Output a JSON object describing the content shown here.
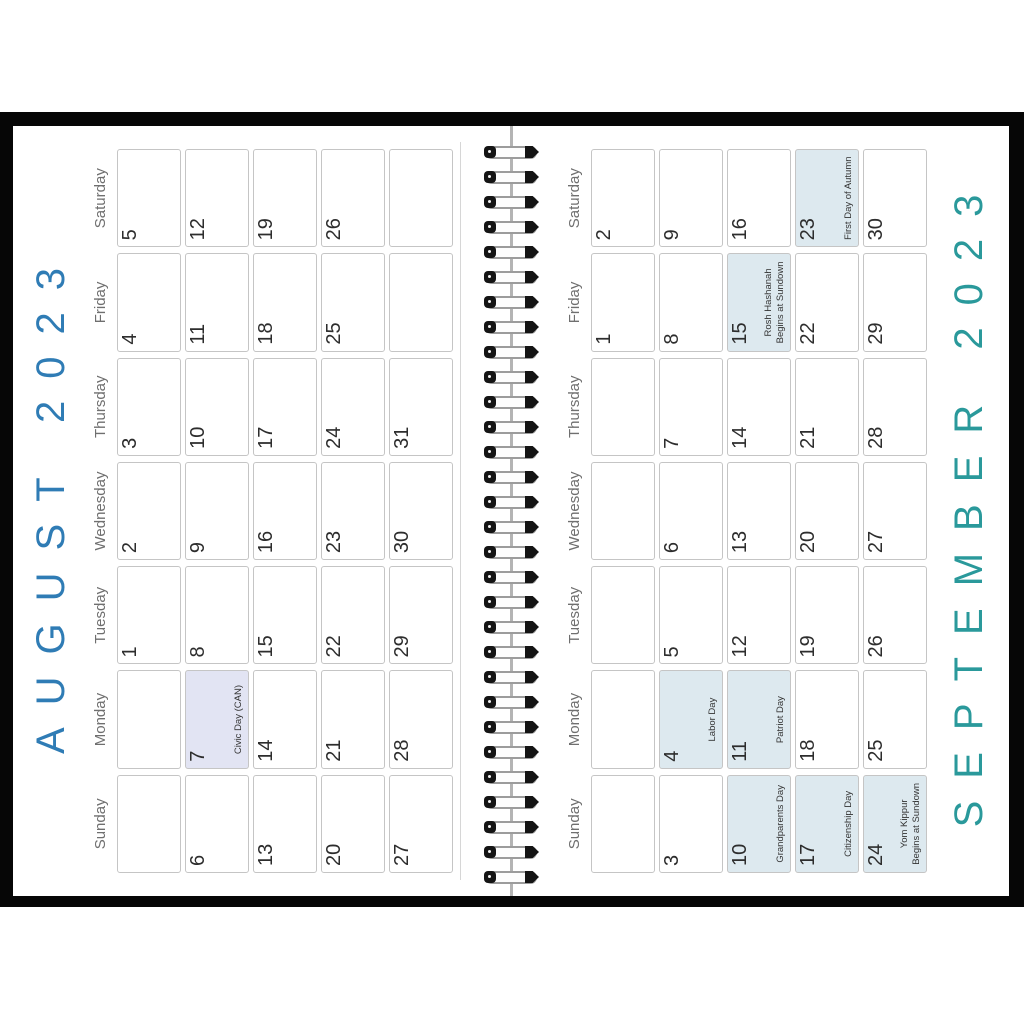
{
  "calendar": {
    "year": "2023",
    "binding": {
      "ring_count": 30
    },
    "pages": [
      {
        "id": "august",
        "title": "AUGUST 2023",
        "title_color": "#2f7cb5",
        "title_position": "top",
        "highlight_color": "#e2e4f3",
        "day_headers": [
          "Sunday",
          "Monday",
          "Tuesday",
          "Wednesday",
          "Thursday",
          "Friday",
          "Saturday"
        ],
        "weeks": [
          [
            {
              "day": ""
            },
            {
              "day": ""
            },
            {
              "day": "1"
            },
            {
              "day": "2"
            },
            {
              "day": "3"
            },
            {
              "day": "4"
            },
            {
              "day": "5"
            }
          ],
          [
            {
              "day": "6"
            },
            {
              "day": "7",
              "holiday": "Civic Day (CAN)",
              "highlight": true
            },
            {
              "day": "8"
            },
            {
              "day": "9"
            },
            {
              "day": "10"
            },
            {
              "day": "11"
            },
            {
              "day": "12"
            }
          ],
          [
            {
              "day": "13"
            },
            {
              "day": "14"
            },
            {
              "day": "15"
            },
            {
              "day": "16"
            },
            {
              "day": "17"
            },
            {
              "day": "18"
            },
            {
              "day": "19"
            }
          ],
          [
            {
              "day": "20"
            },
            {
              "day": "21"
            },
            {
              "day": "22"
            },
            {
              "day": "23"
            },
            {
              "day": "24"
            },
            {
              "day": "25"
            },
            {
              "day": "26"
            }
          ],
          [
            {
              "day": "27"
            },
            {
              "day": "28"
            },
            {
              "day": "29"
            },
            {
              "day": "30"
            },
            {
              "day": "31"
            },
            {
              "day": ""
            },
            {
              "day": ""
            }
          ]
        ]
      },
      {
        "id": "september",
        "title": "SEPTEMBER 2023",
        "title_color": "#2a999b",
        "title_position": "bottom",
        "highlight_color": "#dde9ef",
        "day_headers": [
          "Sunday",
          "Monday",
          "Tuesday",
          "Wednesday",
          "Thursday",
          "Friday",
          "Saturday"
        ],
        "weeks": [
          [
            {
              "day": ""
            },
            {
              "day": ""
            },
            {
              "day": ""
            },
            {
              "day": ""
            },
            {
              "day": ""
            },
            {
              "day": "1"
            },
            {
              "day": "2"
            }
          ],
          [
            {
              "day": "3"
            },
            {
              "day": "4",
              "holiday": "Labor Day",
              "highlight": true
            },
            {
              "day": "5"
            },
            {
              "day": "6"
            },
            {
              "day": "7"
            },
            {
              "day": "8"
            },
            {
              "day": "9"
            }
          ],
          [
            {
              "day": "10",
              "holiday": "Grandparents Day",
              "highlight": true
            },
            {
              "day": "11",
              "holiday": "Patriot Day",
              "highlight": true
            },
            {
              "day": "12"
            },
            {
              "day": "13"
            },
            {
              "day": "14"
            },
            {
              "day": "15",
              "holiday": "Rosh Hashanah\nBegins at Sundown",
              "highlight": true
            },
            {
              "day": "16"
            }
          ],
          [
            {
              "day": "17",
              "holiday": "Citizenship Day",
              "highlight": true
            },
            {
              "day": "18"
            },
            {
              "day": "19"
            },
            {
              "day": "20"
            },
            {
              "day": "21"
            },
            {
              "day": "22"
            },
            {
              "day": "23",
              "holiday": "First Day of Autumn",
              "highlight": true
            }
          ],
          [
            {
              "day": "24",
              "holiday": "Yom Kippur\nBegins at Sundown",
              "highlight": true
            },
            {
              "day": "25"
            },
            {
              "day": "26"
            },
            {
              "day": "27"
            },
            {
              "day": "28"
            },
            {
              "day": "29"
            },
            {
              "day": "30"
            }
          ]
        ]
      }
    ]
  }
}
